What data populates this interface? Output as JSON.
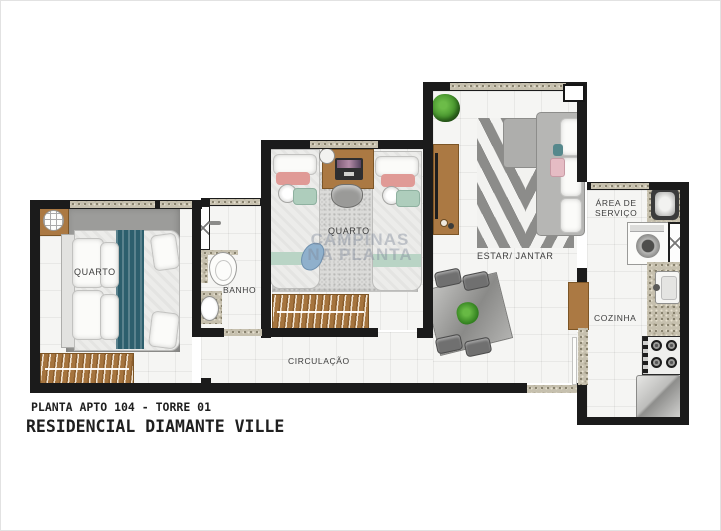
{
  "title_block": {
    "line1": "PLANTA APTO 104 - TORRE 01",
    "line2": "RESIDENCIAL DIAMANTE VILLE"
  },
  "rooms": {
    "bedroom1": {
      "label": "QUARTO"
    },
    "bedroom2": {
      "label": "QUARTO"
    },
    "bathroom": {
      "label": "BANHO"
    },
    "hallway": {
      "label": "CIRCULAÇÃO"
    },
    "living_dining": {
      "label": "ESTAR/ JANTAR"
    },
    "service_area": {
      "label_line1": "ÁREA DE",
      "label_line2": "SERVIÇO"
    },
    "kitchen": {
      "label": "COZINHA"
    }
  },
  "watermark": {
    "line1": "CAMPINAS",
    "line2": "NA PLANTA"
  },
  "colors": {
    "wall": "#1b1b1b",
    "wood": "#a5743e",
    "teal_accent": "#2d5f6d",
    "granite": "#c6c0ae",
    "floor": "#f5f5f3",
    "plant_green": "#4f9c33"
  }
}
